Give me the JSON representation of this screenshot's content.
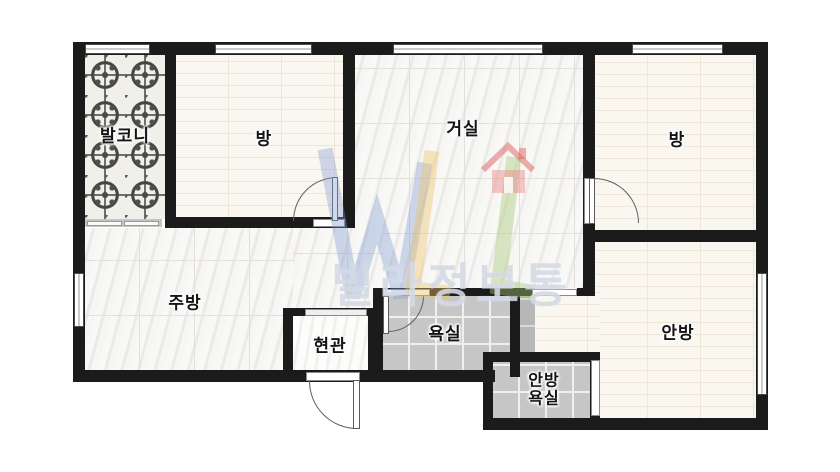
{
  "app": {
    "type": "apartment-floor-plan"
  },
  "watermark": {
    "brand": "빌라정보통",
    "logo_letters": "WL",
    "logo_icon": "house-icon",
    "colors": {
      "w_blue": "#82a0d8",
      "l_yellow": "#e8bf69",
      "l_green": "#aac878",
      "house_red": "#e16969"
    }
  },
  "rooms": [
    {
      "id": "balcony",
      "label": "발코니"
    },
    {
      "id": "room-left",
      "label": "방"
    },
    {
      "id": "living-room",
      "label": "거실"
    },
    {
      "id": "room-right",
      "label": "방"
    },
    {
      "id": "kitchen",
      "label": "주방"
    },
    {
      "id": "entrance",
      "label": "현관"
    },
    {
      "id": "bathroom",
      "label": "욕실"
    },
    {
      "id": "master-bedroom",
      "label": "안방"
    },
    {
      "id": "master-bathroom",
      "label": "안방 욕실",
      "label_lines": [
        "안방",
        "욕실"
      ]
    }
  ],
  "colors": {
    "wall": "#1b1b1b",
    "bath_tile": "#c6c6c6",
    "cream_floor": "#faf7f0",
    "marble_floor": "#f0efec",
    "duct_gray": "#b7b7b7",
    "background": "#ffffff"
  }
}
